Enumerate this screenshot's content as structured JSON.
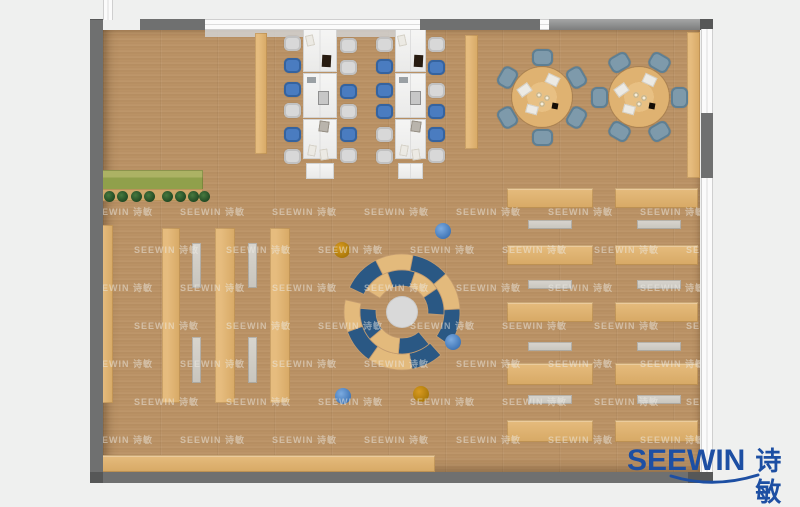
{
  "brand": {
    "latin": "SEEWIN",
    "cjk": "诗敏",
    "logo_color": "#1d4fa3"
  },
  "watermark": {
    "text": "SEEWIN 诗敏",
    "color": "rgba(238,236,230,0.5)",
    "row_y0": 205,
    "row_step": 38,
    "rows": 7,
    "col_x0": 88,
    "col_step": 92,
    "cols": 7,
    "stagger": 46
  },
  "palette": {
    "exterior": "#eff0ef",
    "floor": "#b8916a",
    "wall_dark": "#6f7070",
    "wall_corner": "#565757",
    "beam": "#8d8e8e",
    "window": "#fbfbfb",
    "wood_light": "#e6bc7e",
    "wood_mid": "#d7a965",
    "desk_white": "#f3f3f2",
    "bench": "#d2cfc8",
    "chair_gray": "#d8d8d8",
    "chair_blue": "#4a7cc0",
    "chair_slate": "#7e9aab",
    "seat_navy": "#2a5884",
    "seat_tan": "#e3ba7c",
    "stool_blue": "#3e74b5",
    "stool_orange": "#a87708",
    "plant_dark": "#1f4722",
    "planter_green": "#90a04b",
    "center_circle": "#d9d9d9",
    "sill": "#d2d2d2"
  },
  "plan": {
    "floor": {
      "x": 103,
      "y": 30,
      "w": 597,
      "h": 442
    },
    "walls": [
      {
        "name": "top-left-corner",
        "x": 90,
        "y": 19,
        "w": 13,
        "h": 11,
        "tone": "corner"
      },
      {
        "name": "top-wall-a",
        "x": 140,
        "y": 19,
        "w": 66,
        "h": 11,
        "tone": "dark"
      },
      {
        "name": "top-wall-b",
        "x": 420,
        "y": 19,
        "w": 120,
        "h": 11,
        "tone": "dark"
      },
      {
        "name": "top-beam",
        "x": 549,
        "y": 19,
        "w": 164,
        "h": 11,
        "tone": "beam"
      },
      {
        "name": "top-right-corner",
        "x": 700,
        "y": 19,
        "w": 13,
        "h": 11,
        "tone": "corner"
      },
      {
        "name": "left-wall",
        "x": 90,
        "y": 20,
        "w": 13,
        "h": 463,
        "tone": "dark"
      },
      {
        "name": "right-wall-segment",
        "x": 701,
        "y": 113,
        "w": 12,
        "h": 65,
        "tone": "dark"
      },
      {
        "name": "bottom-wall",
        "x": 90,
        "y": 472,
        "w": 610,
        "h": 11,
        "tone": "dark"
      },
      {
        "name": "bottom-left-corner",
        "x": 90,
        "y": 472,
        "w": 13,
        "h": 11,
        "tone": "corner"
      },
      {
        "name": "bottom-right-corner",
        "x": 688,
        "y": 472,
        "w": 25,
        "h": 11,
        "tone": "corner"
      }
    ],
    "windows": [
      {
        "name": "entry-strip",
        "x": 103,
        "y": 0,
        "w": 10,
        "h": 20,
        "dir": "v"
      },
      {
        "name": "top-window",
        "x": 205,
        "y": 19,
        "w": 215,
        "h": 11,
        "dir": "h"
      },
      {
        "name": "top-window-small",
        "x": 540,
        "y": 19,
        "w": 9,
        "h": 11,
        "dir": "h"
      },
      {
        "name": "right-window-upper",
        "x": 701,
        "y": 29,
        "w": 12,
        "h": 84,
        "dir": "v"
      },
      {
        "name": "right-window-lower",
        "x": 701,
        "y": 178,
        "w": 12,
        "h": 294,
        "dir": "v"
      }
    ],
    "sill": {
      "x": 205,
      "y": 30,
      "w": 215,
      "h": 7
    },
    "planter": {
      "box": {
        "x": 98,
        "y": 170,
        "w": 105,
        "h": 20
      },
      "ledge": {
        "x": 98,
        "y": 189,
        "w": 105,
        "h": 12
      },
      "plant_y": 191,
      "plant_d": 11,
      "plant_xs": [
        104,
        117,
        131,
        144,
        162,
        175,
        188,
        199
      ]
    },
    "stacks": [
      {
        "x": 98,
        "y": 225,
        "w": 15,
        "h": 178
      },
      {
        "x": 162,
        "y": 228,
        "w": 18,
        "h": 175
      },
      {
        "x": 215,
        "y": 228,
        "w": 20,
        "h": 175
      },
      {
        "x": 270,
        "y": 228,
        "w": 20,
        "h": 175
      }
    ],
    "stack_benches": [
      {
        "x": 192,
        "y": 243,
        "w": 9,
        "h": 45
      },
      {
        "x": 248,
        "y": 243,
        "w": 9,
        "h": 45
      },
      {
        "x": 192,
        "y": 337,
        "w": 9,
        "h": 46
      },
      {
        "x": 248,
        "y": 337,
        "w": 9,
        "h": 46
      }
    ],
    "bottom_shelf": {
      "x": 98,
      "y": 455,
      "w": 337,
      "h": 17
    },
    "right_wall_shelf": {
      "x": 687,
      "y": 32,
      "w": 13,
      "h": 146
    },
    "pillars": [
      {
        "x": 255,
        "y": 33,
        "w": 12,
        "h": 121
      },
      {
        "x": 465,
        "y": 35,
        "w": 13,
        "h": 114
      }
    ],
    "desk_columns": [
      {
        "x": 303,
        "w": 34,
        "top": 29,
        "modules": [
          43,
          45,
          40
        ],
        "end_h": 16,
        "chairs_left": {
          "x": 284,
          "ys": [
            36,
            58,
            82,
            103,
            127,
            149
          ],
          "colors": [
            "gray",
            "blue",
            "blue",
            "gray",
            "blue",
            "gray"
          ]
        },
        "chairs_right": {
          "x": 340,
          "ys": [
            38,
            60,
            84,
            104,
            127,
            148
          ],
          "colors": [
            "gray",
            "gray",
            "blue",
            "gray",
            "blue",
            "gray"
          ]
        }
      },
      {
        "x": 395,
        "w": 31,
        "top": 29,
        "modules": [
          43,
          45,
          40
        ],
        "end_h": 16,
        "chairs_left": {
          "x": 376,
          "ys": [
            37,
            59,
            83,
            104,
            127,
            149
          ],
          "colors": [
            "gray",
            "blue",
            "blue",
            "blue",
            "gray",
            "gray"
          ]
        },
        "chairs_right": {
          "x": 428,
          "ys": [
            37,
            60,
            83,
            104,
            127,
            148
          ],
          "colors": [
            "gray",
            "blue",
            "gray",
            "blue",
            "blue",
            "gray"
          ]
        }
      }
    ],
    "desk_chair": {
      "w": 17,
      "h": 15
    },
    "desk_props": [
      {
        "t": "paper",
        "dx": 3,
        "dy": 6,
        "w": 8,
        "h": 11,
        "rot": -12
      },
      {
        "t": "laptop",
        "dx": 19,
        "dy": 26,
        "w": 9,
        "h": 12,
        "rot": 3
      },
      {
        "t": "device",
        "dx": 4,
        "dy": 48,
        "w": 9,
        "h": 6,
        "rot": 0
      },
      {
        "t": "monitor",
        "dx": 15,
        "dy": 62,
        "w": 11,
        "h": 14,
        "rot": 0
      },
      {
        "t": "tablet",
        "dx": 16,
        "dy": 92,
        "w": 10,
        "h": 11,
        "rot": 8
      },
      {
        "t": "paper",
        "dx": 5,
        "dy": 116,
        "w": 8,
        "h": 11,
        "rot": 10
      },
      {
        "t": "paper",
        "dx": 17,
        "dy": 120,
        "w": 8,
        "h": 11,
        "rot": -8
      }
    ],
    "round_tables": [
      {
        "cx": 542,
        "cy": 97,
        "r": 30,
        "chair_angles": [
          -90,
          -30,
          30,
          90,
          150,
          210
        ]
      },
      {
        "cx": 639,
        "cy": 97,
        "r": 30,
        "chair_angles": [
          -60,
          0,
          60,
          120,
          180,
          240
        ]
      }
    ],
    "round_chair": {
      "w": 21,
      "h": 17,
      "orbit": 40
    },
    "table_props": [
      {
        "t": "paper",
        "dx": -24,
        "dy": -12,
        "w": 13,
        "h": 10,
        "rot": -35
      },
      {
        "t": "paper",
        "dx": 4,
        "dy": -22,
        "w": 13,
        "h": 10,
        "rot": 25
      },
      {
        "t": "paper",
        "dx": -16,
        "dy": 8,
        "w": 12,
        "h": 9,
        "rot": 15
      },
      {
        "t": "black",
        "dx": 10,
        "dy": 6,
        "w": 6,
        "h": 6,
        "rot": 10
      },
      {
        "t": "cup",
        "dx": -6,
        "dy": -5,
        "d": 6
      },
      {
        "t": "cup",
        "dx": 2,
        "dy": -2,
        "d": 6
      },
      {
        "t": "cup",
        "dx": -3,
        "dy": 4,
        "d": 6
      }
    ],
    "right_rows": {
      "cols": [
        {
          "x": 507,
          "w": 86,
          "bench_x": 528
        },
        {
          "x": 615,
          "w": 83,
          "bench_x": 637
        }
      ],
      "row_ys": [
        188,
        245,
        302,
        363,
        420
      ],
      "row_hs": [
        20,
        20,
        20,
        22,
        22
      ],
      "bench_ys": [
        220,
        280,
        342,
        395
      ],
      "bench_w": 44,
      "bench_h": 9
    },
    "circle_group": {
      "cx": 402,
      "cy": 312,
      "center_r": 15,
      "r_inner": [
        26,
        42
      ],
      "r_outer": [
        42,
        58
      ],
      "top_outer": [
        [
          -155,
          -117,
          "n"
        ],
        [
          -117,
          -79,
          "t"
        ],
        [
          -79,
          -41,
          "n"
        ],
        [
          -41,
          -3,
          "t"
        ],
        [
          -3,
          35,
          "n"
        ]
      ],
      "top_inner": [
        [
          -148,
          -110,
          "t"
        ],
        [
          -110,
          -72,
          "n"
        ],
        [
          -72,
          -34,
          "t"
        ],
        [
          -34,
          4,
          "n"
        ]
      ],
      "bottom_outer": [
        [
          48,
          80,
          "n"
        ],
        [
          80,
          125,
          "t"
        ],
        [
          125,
          160,
          "n"
        ],
        [
          160,
          192,
          "t"
        ]
      ],
      "bottom_inner": [
        [
          50,
          95,
          "n"
        ],
        [
          95,
          140,
          "t"
        ],
        [
          140,
          185,
          "n"
        ]
      ],
      "stools": [
        {
          "x": 443,
          "y": 231,
          "c": "blue"
        },
        {
          "x": 342,
          "y": 250,
          "c": "orange"
        },
        {
          "x": 453,
          "y": 342,
          "c": "blue"
        },
        {
          "x": 421,
          "y": 394,
          "c": "orange"
        },
        {
          "x": 343,
          "y": 396,
          "c": "blue"
        }
      ],
      "stool_r": 8
    }
  }
}
